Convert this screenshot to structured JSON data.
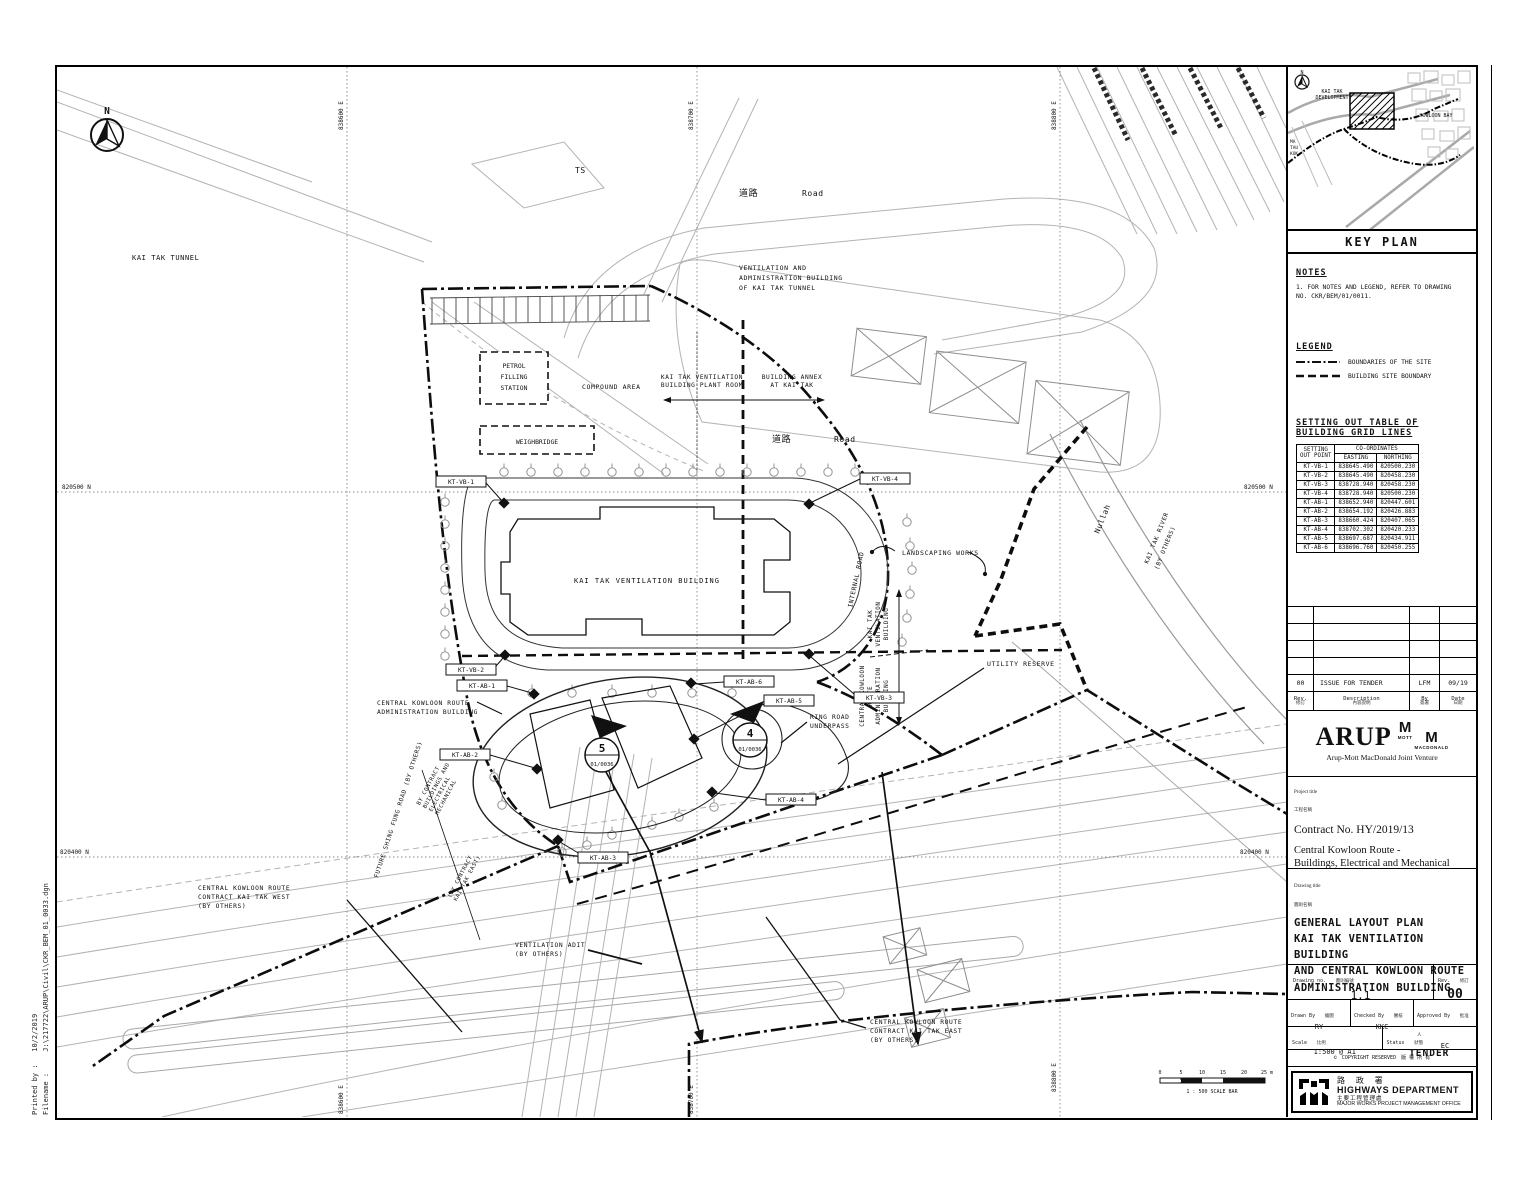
{
  "page": {
    "printed_by_label": "Printed by :",
    "printed_date": "10/2/2019",
    "filename_label": "Filename :",
    "filename": "J:\\217722\\ARUP\\Civil\\CKR_BEM_01_0033.dgn"
  },
  "map": {
    "north": "N",
    "grid": {
      "eastings": [
        "838600 E",
        "838700 E",
        "838800 E"
      ],
      "northings": [
        "820500 N",
        "820400 N"
      ]
    },
    "labels": {
      "kai_tak_tunnel": "KAI TAK TUNNEL",
      "ts": "TS",
      "road_cn": "道路",
      "road_en": "Road",
      "vab_l1": "VENTILATION AND",
      "vab_l2": "ADMINISTRATION BUILDING",
      "vab_l3": "OF KAI TAK TUNNEL",
      "plant_room_l1": "KAI TAK VENTILATION",
      "plant_room_l2": "BUILDING PLANT ROOM",
      "annex_l1": "BUILDING ANNEX",
      "annex_l2": "AT KAI TAK",
      "petrol_l1": "PETROL",
      "petrol_l2": "FILLING",
      "petrol_l3": "STATION",
      "compound": "COMPOUND AREA",
      "weighbridge": "WEIGHBRIDGE",
      "ktvb": "KAI TAK VENTILATION BUILDING",
      "internal_road": "INTERNAL ROAD",
      "landscaping": "LANDSCAPING WORKS",
      "utility": "UTILITY RESERVE",
      "nullah": "Nullah",
      "river_l1": "KAI TAK RIVER",
      "river_l2": "(BY OTHERS)",
      "ckr_admin_l1": "CENTRAL KOWLOON ROUTE",
      "ckr_admin_l2": "ADMINISTRATION BUILDING",
      "ring_road_l1": "RING ROAD",
      "ring_road_l2": "UNDERPASS",
      "vent_adit_l1": "VENTILATION ADIT",
      "vent_adit_l2": "(BY OTHERS)",
      "ckr_west_l1": "CENTRAL KOWLOON ROUTE",
      "ckr_west_l2": "CONTRACT KAI TAK WEST",
      "ckr_west_l3": "(BY OTHERS)",
      "ckr_east_l1": "CENTRAL KOWLOON ROUTE",
      "ckr_east_l2": "CONTRACT KAI TAK EAST",
      "ckr_east_l3": "(BY OTHERS)",
      "shing_fung": "FUTURE SHING FUNG ROAD (BY OTHERS)",
      "by_contract_bem_l1": "BY CONTRACT",
      "by_contract_bem_l2": "BUILDINGS AND",
      "by_contract_bem_l3": "ELECTRICAL",
      "by_contract_bem_l4": "MECHANICAL",
      "by_contract_kte_l1": "(BY CONTRACT",
      "by_contract_kte_l2": "KAI TAK EAST)",
      "side_vb_l1": "KAI TAK",
      "side_vb_l2": "VENTILATION",
      "side_vb_l3": "BUILDING",
      "side_ab_l1": "CENTRAL KOWLOON",
      "side_ab_l2": "ROUTE",
      "side_ab_l3": "ADMINISTRATION",
      "side_ab_l4": "BUILDING"
    },
    "markers": {
      "vb1": "KT-VB-1",
      "vb2": "KT-VB-2",
      "vb3": "KT-VB-3",
      "vb4": "KT-VB-4",
      "ab1": "KT-AB-1",
      "ab2": "KT-AB-2",
      "ab3": "KT-AB-3",
      "ab4": "KT-AB-4",
      "ab5": "KT-AB-5",
      "ab6": "KT-AB-6"
    },
    "sections": {
      "s5_no": "5",
      "s5_ref": "01/0036",
      "s4_no": "4",
      "s4_ref": "01/0036"
    },
    "scale_bar": {
      "ticks": [
        "0",
        "5",
        "10",
        "15",
        "20",
        "25 m"
      ],
      "caption": "1 : 500  SCALE BAR"
    }
  },
  "key_plan": {
    "title": "KEY PLAN",
    "labels": {
      "development_l1": "KAI TAK",
      "development_l2": "DEVELOPMENT",
      "kowloon_bay": "KOWLOON BAY",
      "ma_l1": "MA",
      "ma_l2": "TAU",
      "ma_l3": "KOK"
    }
  },
  "notes": {
    "heading": "NOTES",
    "item_l1": "1. FOR NOTES AND LEGEND, REFER TO DRAWING",
    "item_l2": "   NO. CKR/BEM/01/0011."
  },
  "legend": {
    "heading": "LEGEND",
    "items": [
      {
        "label": "BOUNDARIES OF THE SITE"
      },
      {
        "label": "BUILDING SITE BOUNDARY"
      }
    ]
  },
  "setting_out_table": {
    "heading_l1": "SETTING OUT TABLE OF",
    "heading_l2": "BUILDING GRID LINES",
    "col_point_l1": "SETTING",
    "col_point_l2": "OUT POINT",
    "col_coords": "CO-ORDINATES",
    "col_easting": "EASTING",
    "col_northing": "NORTHING",
    "rows": [
      [
        "KT-VB-1",
        "838645.490",
        "820500.230"
      ],
      [
        "KT-VB-2",
        "838645.490",
        "820458.230"
      ],
      [
        "KT-VB-3",
        "838728.940",
        "820458.230"
      ],
      [
        "KT-VB-4",
        "838728.940",
        "820500.230"
      ],
      [
        "KT-AB-1",
        "838652.940",
        "820447.601"
      ],
      [
        "KT-AB-2",
        "838654.192",
        "820426.883"
      ],
      [
        "KT-AB-3",
        "838660.424",
        "820407.065"
      ],
      [
        "KT-AB-4",
        "838702.302",
        "820420.233"
      ],
      [
        "KT-AB-5",
        "838697.687",
        "820434.911"
      ],
      [
        "KT-AB-6",
        "838696.760",
        "820450.255"
      ]
    ]
  },
  "revision": {
    "row": {
      "rev": "00",
      "description": "ISSUE FOR TENDER",
      "by": "LFM",
      "date": "09/19"
    },
    "header": {
      "rev": "Rev.",
      "rev_cn": "修訂",
      "description": "Description",
      "description_cn": "內容說明",
      "by": "By",
      "by_cn": "簽署",
      "date": "Date",
      "date_cn": "日期"
    }
  },
  "firm": {
    "arup": "ARUP",
    "m1": "M",
    "mott": "MOTT",
    "m2": "M",
    "macdonald": "MACDONALD",
    "jv": "Arup-Mott MacDonald Joint Venture"
  },
  "project": {
    "label": "Project title",
    "label_cn": "工程名稱",
    "contract": "Contract No. HY/2019/13",
    "title_l1": "Central Kowloon Route -",
    "title_l2": "Buildings, Electrical and Mechanical"
  },
  "drawing": {
    "label": "Drawing title",
    "label_cn": "圖則名稱",
    "title_l1": "GENERAL LAYOUT PLAN",
    "title_l2": "KAI TAK VENTILATION BUILDING",
    "title_l3": "AND CENTRAL KOWLOON ROUTE",
    "title_l4": "ADMINISTRATION BUILDING"
  },
  "title_block": {
    "drawing_no_label": "Drawing no.",
    "drawing_no_cn": "圖則編號",
    "drawing_no": "1.1",
    "rev_label": "Rev.",
    "rev_cn": "修訂",
    "rev": "00",
    "drawn_label": "Drawn By",
    "drawn_cn": "繪圖",
    "drawn": "RY",
    "checked_label": "Checked By",
    "checked_cn": "審核",
    "checked": "KKC",
    "approved_label": "Approved By",
    "approved_cn": "批准人",
    "approved": "EC",
    "scale_label": "Scale",
    "scale_cn": "比例",
    "scale": "1:500 @ A1",
    "status_label": "Status",
    "status_cn": "狀態",
    "status": "TENDER",
    "copyright_sym": "©",
    "copyright": "COPYRIGHT RESERVED",
    "copyright_cn": "版 權 所 有"
  },
  "department": {
    "name_cn": "路 政 署",
    "name": "HIGHWAYS DEPARTMENT",
    "office_cn": "主要工程管理處",
    "office": "MAJOR WORKS PROJECT MANAGEMENT OFFICE"
  }
}
